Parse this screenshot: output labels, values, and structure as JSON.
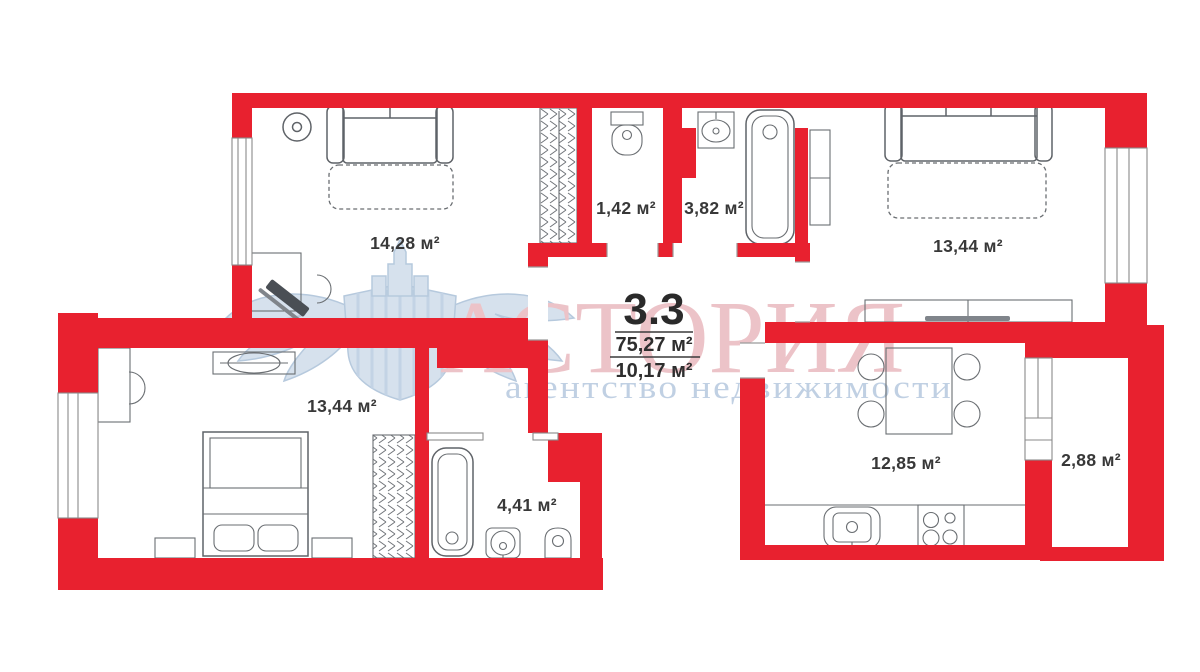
{
  "plan": {
    "unit_number": "3.3",
    "total_area": "75,27 м²",
    "secondary_area": "10,17 м²"
  },
  "rooms": [
    {
      "id": "living-room",
      "area": "14,28 м²"
    },
    {
      "id": "wc",
      "area": "1,42 м²"
    },
    {
      "id": "bathroom",
      "area": "3,82 м²"
    },
    {
      "id": "bedroom-right",
      "area": "13,44 м²"
    },
    {
      "id": "bedroom-left",
      "area": "13,44 м²"
    },
    {
      "id": "shower-room",
      "area": "4,41 м²"
    },
    {
      "id": "kitchen",
      "area": "12,85 м²"
    },
    {
      "id": "balcony",
      "area": "2,88 м²"
    }
  ],
  "watermark": {
    "brand": "АСТОРИЯ",
    "tagline": "агентство недвижимости"
  },
  "colors": {
    "wall": "#e8212f",
    "watermark_brand": "#e2a0a7",
    "watermark_tagline": "#9bb4d2",
    "furniture_outline": "#5f6368",
    "label_text": "#383838"
  }
}
